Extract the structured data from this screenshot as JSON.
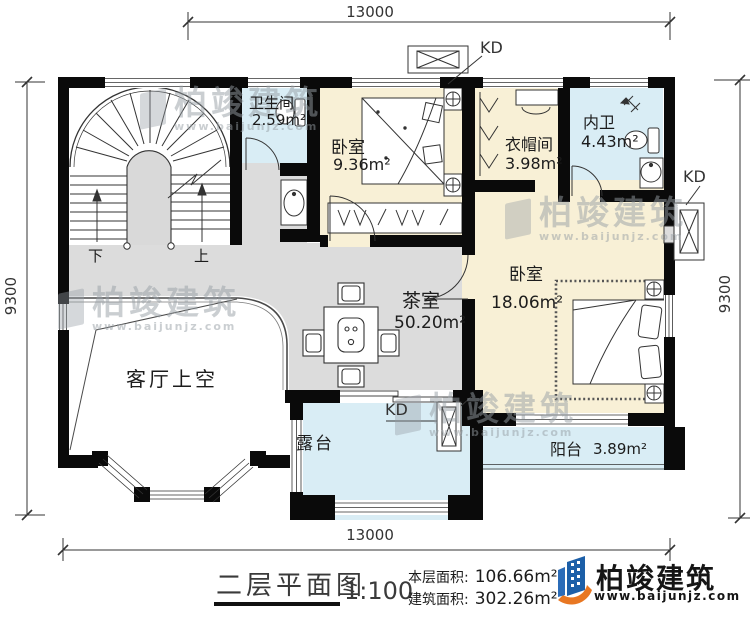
{
  "plan": {
    "title": "二层平面图",
    "scale": "1:100",
    "areas": {
      "floor_label": "本层面积:",
      "floor_value": "106.66m²",
      "building_label": "建筑面积:",
      "building_value": "302.26m²"
    },
    "dimensions": {
      "top": "13000",
      "bottom": "13000",
      "left": "9300",
      "right": "9300"
    },
    "rooms": {
      "bathroom": {
        "name": "卫生间",
        "area": "2.59m²"
      },
      "bedroom_small": {
        "name": "卧室",
        "area": "9.36m²"
      },
      "cloakroom": {
        "name": "衣帽间",
        "area": "3.98m²"
      },
      "ensuite": {
        "name": "内卫",
        "area": "4.43m²"
      },
      "bedroom_large": {
        "name": "卧室",
        "area": "18.06m²"
      },
      "tea_room": {
        "name": "茶室",
        "area": "50.20m²"
      },
      "living_void": {
        "name": "客厅上空"
      },
      "terrace": {
        "name": "露台"
      },
      "balcony": {
        "name": "阳台",
        "area": "3.89m²"
      }
    },
    "stairs": {
      "down_label": "下",
      "up_label": "上"
    },
    "ac_unit_label": "KD"
  },
  "branding": {
    "company": "柏竣建筑",
    "website": "www.baijunjz.com"
  },
  "watermark": {
    "text": "柏竣建筑",
    "subtext": "www.baijunjz.com"
  },
  "colors": {
    "wall": "#0a0a0a",
    "hall_floor": "#dcdcdc",
    "room_cream": "#f8f0d6",
    "room_blue": "#d9edf5",
    "logo_blue": "#1c5fa8",
    "logo_orange": "#e87722"
  }
}
